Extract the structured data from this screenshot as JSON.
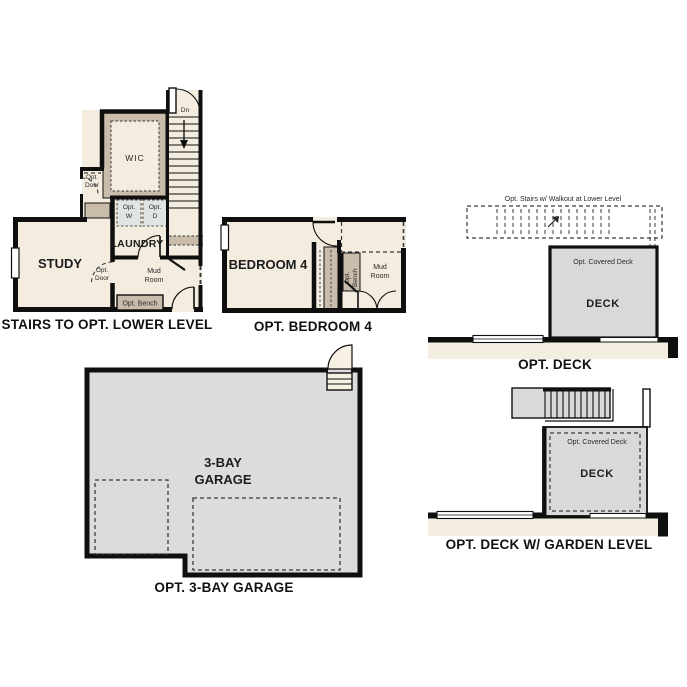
{
  "colors": {
    "wall": "#0f0f0f",
    "room_fill": "#f3ecdf",
    "tan_accent": "#c9bcaa",
    "deck_gray": "#d9d9d9",
    "garage_gray": "#dcdcdc",
    "washer_dryer_gray": "#e0e4e3",
    "house_strip_beige": "#f4eee1",
    "background": "#ffffff"
  },
  "plans": {
    "stairs_lower": {
      "caption": "STAIRS TO OPT. LOWER LEVEL",
      "study": "STUDY",
      "wic": "WIC",
      "laundry": "LAUNDRY",
      "dn": "Dn",
      "mud_line1": "Mud",
      "mud_line2": "Room",
      "opt_door_line1": "Opt.",
      "opt_door_line2": "Door",
      "opt_w_line1": "Opt.",
      "opt_w_line2": "W",
      "opt_d_line1": "Opt.",
      "opt_d_line2": "D",
      "opt_bench": "Opt. Bench"
    },
    "bedroom4": {
      "caption": "OPT. BEDROOM 4",
      "bedroom": "BEDROOM 4",
      "bench_line1": "Opt.",
      "bench_line2": "Bench",
      "mud_line1": "Mud",
      "mud_line2": "Room"
    },
    "deck": {
      "caption": "OPT. DECK",
      "stairs_note": "Opt. Stairs w/ Walkout at Lower Level",
      "covered": "Opt. Covered Deck",
      "deck": "DECK"
    },
    "deck_garden": {
      "caption": "OPT. DECK W/ GARDEN LEVEL",
      "covered": "Opt. Covered Deck",
      "deck": "DECK"
    },
    "garage": {
      "caption": "OPT. 3-BAY GARAGE",
      "label_line1": "3-BAY",
      "label_line2": "GARAGE"
    }
  }
}
